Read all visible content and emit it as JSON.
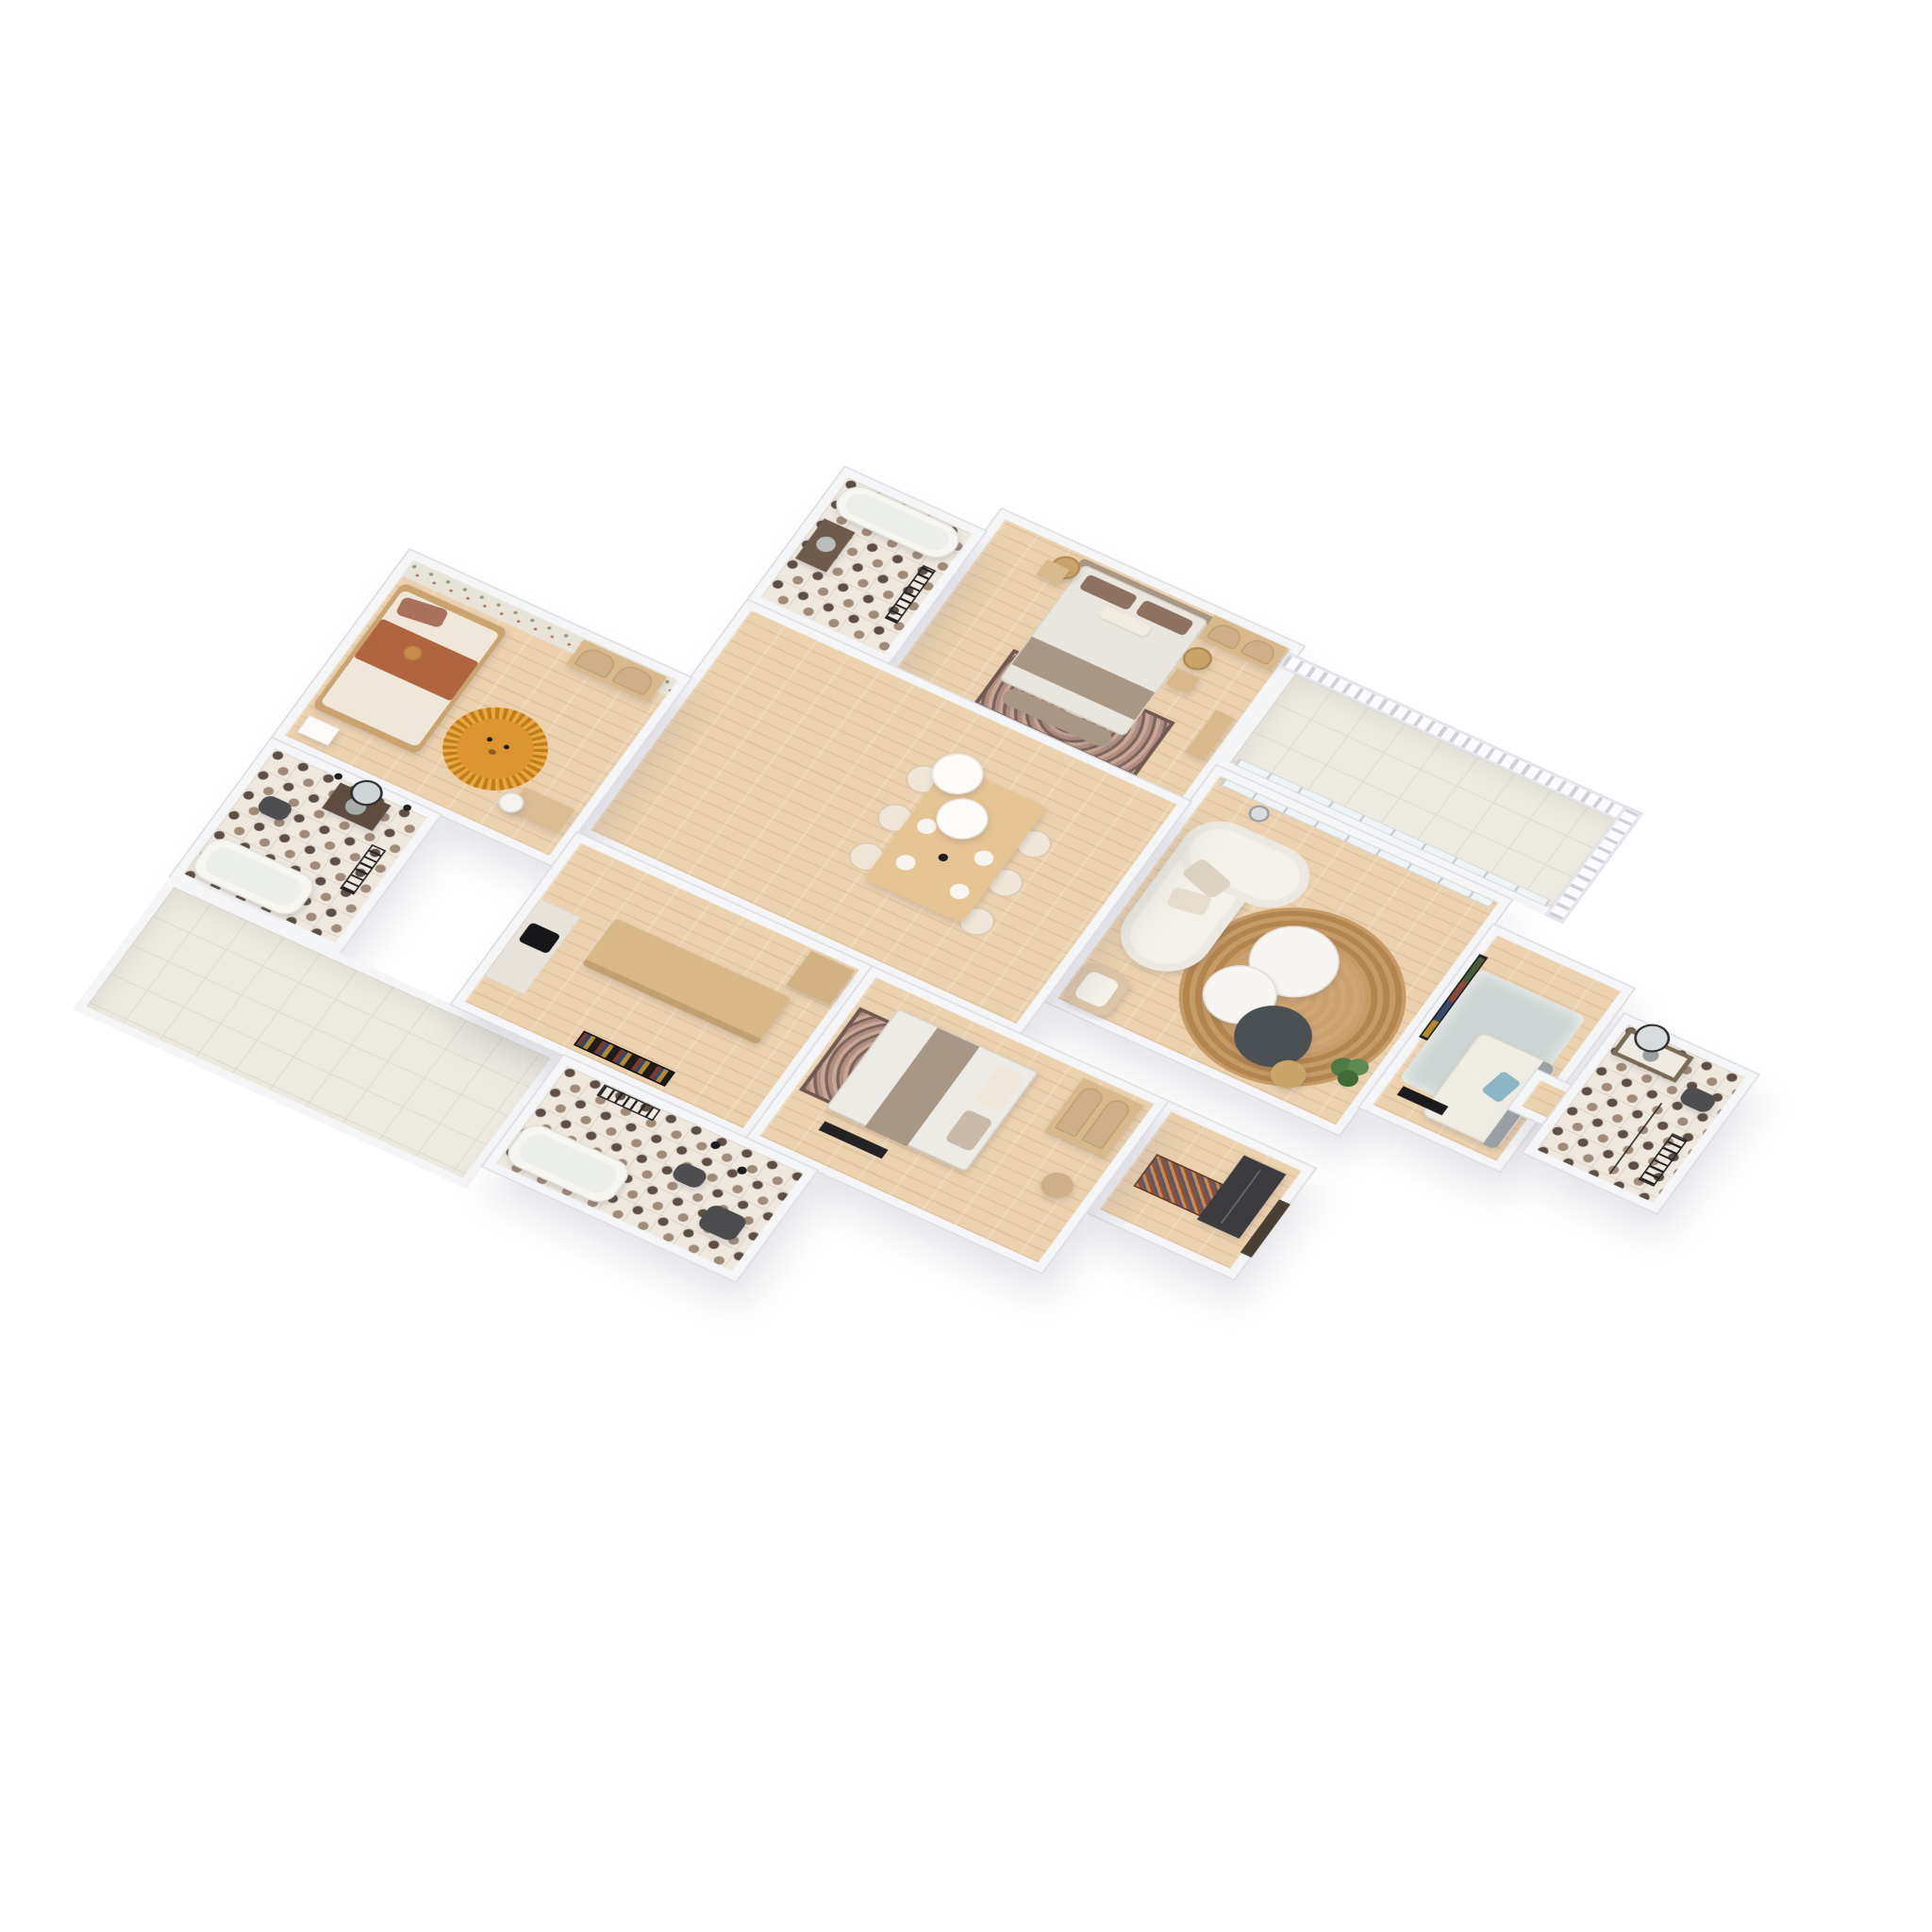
{
  "scene": {
    "type": "isometric-3d-floor-plan",
    "description": "Isometric 3D rendered floor plan of a three-bedroom apartment with living-dining area, kitchen island, four bathrooms, balcony and large tiled terrace, on a white background",
    "background": "#ffffff",
    "view_angle": "axonometric, plan rotated ~30 degrees, tilted ~38 degrees"
  },
  "palette": {
    "wall_top": "#f4f5f7",
    "wall_edge": "#dcdde3",
    "wood_floor": "#ebd1ad",
    "tile_light": "#edeae1",
    "tile_grid": "#ded9cd",
    "tile_pattern_dark": "#5d4f45",
    "tile_pattern_brown": "#a08a78",
    "sofa_white": "#f4f1ea",
    "marble": "#f7f5f1",
    "dark_table": "#4b5054",
    "jute_rug": "#b3854f",
    "wardrobe_wood": "#d9b98c",
    "blanket_taupe": "#a89784",
    "pillow_brown": "#8d7161",
    "kids_blanket_terracotta": "#b0643f",
    "lion_rug_amber": "#dd9630",
    "plush_rug_blue_gray": "#ccd5d3",
    "fixture_dark": "#4e4e50",
    "accent_black": "#1d1d1f",
    "plant_green": "#4e7a46"
  },
  "rooms": [
    {
      "id": "master-bedroom",
      "name": "Master bedroom",
      "floor": "wood",
      "furniture": [
        "double bed with white duvet and taupe blanket",
        "two brown pillows",
        "white lumbar pillow",
        "upholstered headboard",
        "two rattan pendant lamps",
        "two wood nightstands",
        "glass-door arched wardrobe",
        "foot bench",
        "ornate area rug",
        "wall console"
      ]
    },
    {
      "id": "master-bathroom",
      "name": "Master en-suite bathroom",
      "floor": "patterned-tile",
      "furniture": [
        "bathtub",
        "black towel radiator",
        "dark wood vanity with basin"
      ]
    },
    {
      "id": "balcony",
      "name": "Balcony",
      "floor": "light-tile",
      "furniture": [
        "balustrade railing",
        "glazed wall to living room"
      ]
    },
    {
      "id": "living-room",
      "name": "Living room",
      "floor": "wood",
      "furniture": [
        "curved white boucle sofa",
        "round jute rug",
        "two round marble coffee tables",
        "dark round coffee table",
        "tan stool",
        "tripod floor lamp",
        "potted plant",
        "rattan armchair",
        "wall TV"
      ]
    },
    {
      "id": "dining-area",
      "name": "Dining area / hall",
      "floor": "wood",
      "furniture": [
        "rectangular wood dining table",
        "six cream dining chairs",
        "table place settings",
        "two white dome pendant lamps"
      ]
    },
    {
      "id": "office-room",
      "name": "Office / guest room",
      "floor": "wood",
      "furniture": [
        "plush blue-gray rug",
        "cream daybed with gray back and blue throw",
        "black media bench",
        "wall TV facing living room"
      ]
    },
    {
      "id": "right-bathroom",
      "name": "Second bathroom",
      "floor": "patterned-tile",
      "furniture": [
        "vanity with basin",
        "round black-frame mirror",
        "wall-hung toilet",
        "black towel ladder",
        "shower screen"
      ]
    },
    {
      "id": "entry",
      "name": "Entry hall",
      "floor": "wood",
      "furniture": [
        "dark front door",
        "patterned runner rug",
        "tall dark closet"
      ]
    },
    {
      "id": "kids-bedroom",
      "name": "Kids bedroom",
      "floor": "wood",
      "furniture": [
        "single bed with terracotta blanket",
        "teddy bear",
        "lion-shaped amber rug",
        "white nightstand",
        "two arched cane wardrobes",
        "desk with white chair",
        "floral wallpaper wall"
      ]
    },
    {
      "id": "left-bathroom",
      "name": "Family bathroom",
      "floor": "patterned-tile",
      "furniture": [
        "bathtub",
        "dark wall-hung toilet",
        "dark wood vanity with concrete basin",
        "round black-frame mirror",
        "two black sconces",
        "black towel ladder"
      ]
    },
    {
      "id": "terrace",
      "name": "Terrace",
      "floor": "light-tile",
      "furniture": []
    },
    {
      "id": "kitchen",
      "name": "Kitchen",
      "floor": "wood",
      "furniture": [
        "long wood island",
        "black farmhouse sink counter",
        "tall wood cabinet",
        "leaning framed artwork"
      ]
    },
    {
      "id": "guest-bedroom",
      "name": "Guest bedroom",
      "floor": "wood",
      "furniture": [
        "double bed with white duvet and taupe blanket band",
        "ornate area rug",
        "arched cane wardrobe",
        "round side table",
        "black foot bench"
      ]
    },
    {
      "id": "guest-bathroom",
      "name": "Guest bathroom",
      "floor": "patterned-tile",
      "furniture": [
        "bathtub",
        "dark wall-hung toilet",
        "dark vanity seat",
        "black towel rack"
      ]
    }
  ]
}
